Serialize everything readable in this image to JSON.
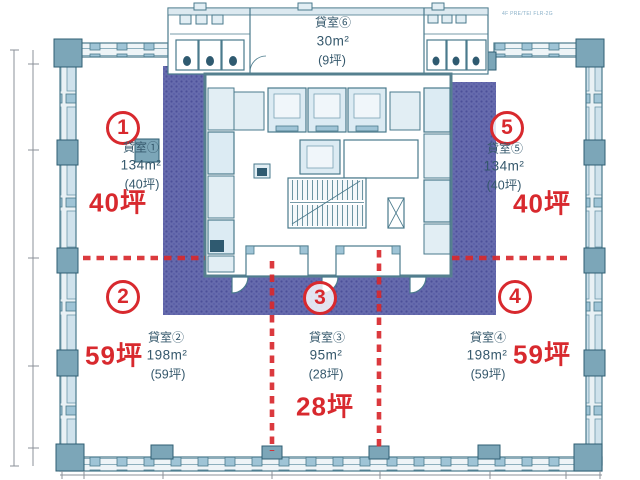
{
  "rooms": [
    {
      "circle": "1",
      "name": "貸室①",
      "area": "134m²",
      "tsubo": "(40坪)",
      "big": "40坪"
    },
    {
      "circle": "2",
      "name": "貸室②",
      "area": "198m²",
      "tsubo": "(59坪)",
      "big": "59坪"
    },
    {
      "circle": "3",
      "name": "貸室③",
      "area": "95m²",
      "tsubo": "(28坪)",
      "big": "28坪"
    },
    {
      "circle": "4",
      "name": "貸室④",
      "area": "198m²",
      "tsubo": "(59坪)",
      "big": "59坪"
    },
    {
      "circle": "5",
      "name": "貸室⑤",
      "area": "134m²",
      "tsubo": "(40坪)",
      "big": "40坪"
    },
    {
      "name": "貸室⑥",
      "area": "30m²",
      "tsubo": "(9坪)"
    }
  ],
  "annotation": "4F PRE/TEI FLR-2G",
  "colors": {
    "leased_band": "#666bad",
    "accent_red": "#d8292e",
    "wall_teal": "#7ca6b8"
  }
}
